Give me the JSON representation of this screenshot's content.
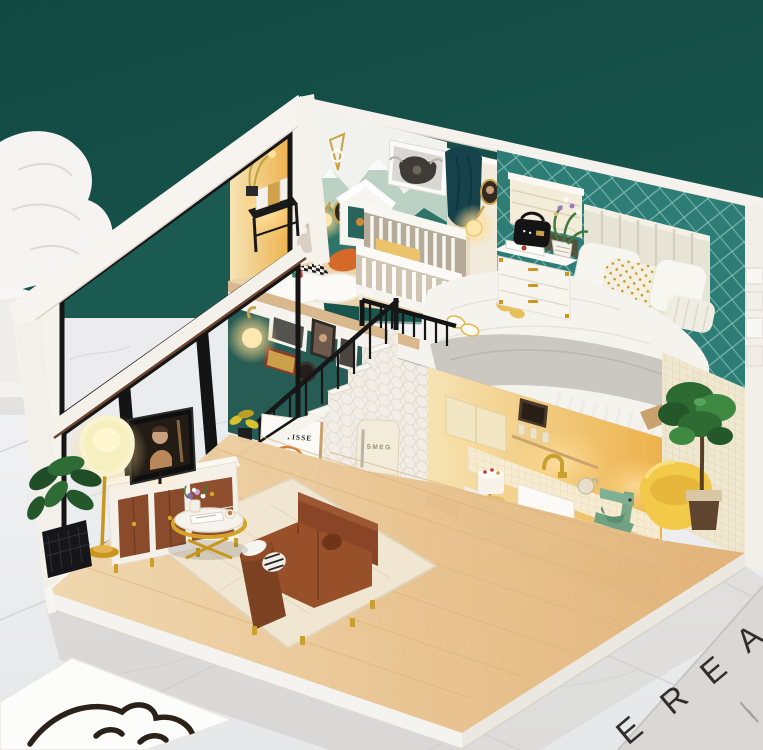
{
  "scene": {
    "type": "product photograph",
    "subject": "DIY miniature dollhouse diorama – two-story loft apartment with lights on",
    "background": {
      "wall": "dark teal painted wall",
      "wall_color": "#175850",
      "floor": "white marble tile floor",
      "floor_color": "#eff0f1"
    },
    "props": {
      "sculpture": "white plaster drapery sculpture (left edge)",
      "left_floor_card": "white tile with black single-line face art (bottom-left)",
      "right_floor_card": "grey card with large thin capital letters (bottom-right)"
    }
  },
  "texts": {
    "poster_title": "MATISSE",
    "fridge_brand": "SMEG",
    "floor_letters": [
      "E",
      "R",
      "E",
      "A"
    ]
  },
  "palette": {
    "background_teal": "#175850",
    "interior_teal_wall": "#275c54",
    "bedroom_lattice_teal": "#2d7c76",
    "wood_floor": "#e8cda3",
    "gold_accent": "#c9961e",
    "sofa_brown": "#8a4a2b",
    "kitchen_cabinet_green": "#7fb5a0",
    "bathtub_yellow": "#f3c94a",
    "warm_glow": "#ffd98e",
    "house_white": "#f6f3ee",
    "marble": "#eff0f1"
  },
  "rooms": {
    "upper_floor": {
      "nursery": [
        "white crib",
        "mountain mural",
        "highland cow art print",
        "toy gable house",
        "rainbow toy",
        "teddy bear",
        "teal star pillow",
        "orange pillow",
        "black reading console with books",
        "checkerboard floor",
        "white fluffy rug",
        "wall sconce",
        "oval portrait"
      ],
      "bedroom": [
        "double bed with channel-tufted headboard",
        "gold-dotted pillow",
        "grey fringed throw",
        "slippers",
        "white nightstand with gold handles",
        "black radio",
        "flower pot",
        "roman shade window",
        "cameo portrait",
        "glowing wall sconce",
        "teal lattice wallpaper",
        "black loft guard railing"
      ]
    },
    "lower_floor": {
      "living_room": [
        "flat TV",
        "white and walnut media console",
        "yellow floor lamp",
        "gold round coffee table",
        "brown leather sofa",
        "cream area rug",
        "teal gallery wall with frames",
        "glowing globe sconce",
        "MATISSE poster",
        "staircase with black railing",
        "monstera plant in black basket"
      ],
      "dining": [
        "wood trestle table",
        "cream chairs with gold legs",
        "tiered white cake",
        "pink dessert",
        "plates",
        "blue candle"
      ],
      "kitchen": [
        "SMEG fridge",
        "sage green cabinets",
        "farmhouse sink",
        "gold faucet",
        "green stand mixer",
        "cake stand",
        "glowing oven",
        "yellow tile wall"
      ],
      "bath": [
        "yellow freestanding tub",
        "fiddle leaf fig tree",
        "black dotted tile floor",
        "cream mosaic wall",
        "outside white stairs"
      ]
    }
  }
}
